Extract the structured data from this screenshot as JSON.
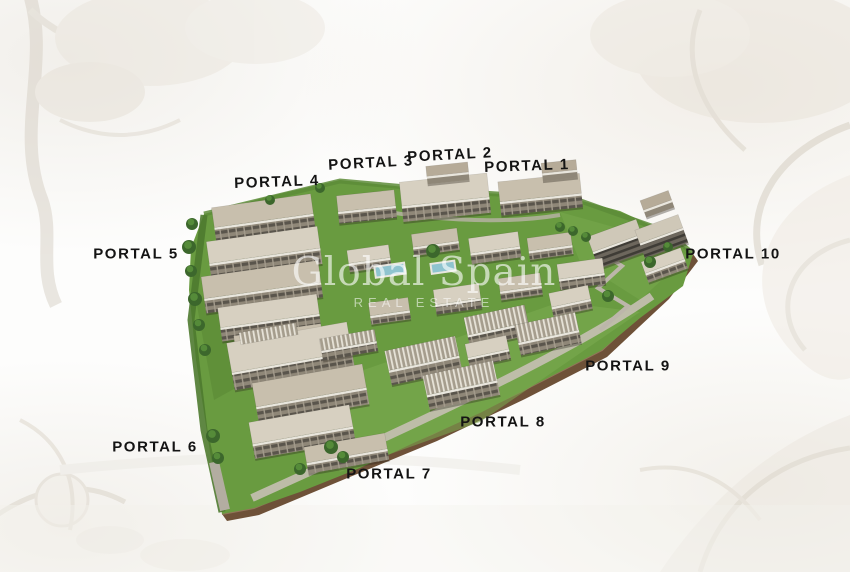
{
  "watermark": {
    "brand": "Global Spain",
    "tagline": "REAL ESTATE"
  },
  "site": {
    "portals": [
      {
        "id": "portal-1",
        "label": "PORTAL 1"
      },
      {
        "id": "portal-2",
        "label": "PORTAL 2"
      },
      {
        "id": "portal-3",
        "label": "PORTAL 3"
      },
      {
        "id": "portal-4",
        "label": "PORTAL 4"
      },
      {
        "id": "portal-5",
        "label": "PORTAL 5"
      },
      {
        "id": "portal-6",
        "label": "PORTAL 6"
      },
      {
        "id": "portal-7",
        "label": "PORTAL 7"
      },
      {
        "id": "portal-8",
        "label": "PORTAL 8"
      },
      {
        "id": "portal-9",
        "label": "PORTAL 9"
      },
      {
        "id": "portal-10",
        "label": "PORTAL 10"
      }
    ]
  },
  "colors": {
    "label_text": "#141414",
    "grass": "#699b40",
    "grass_light": "#7cab51",
    "building_roof": "#c8bfad",
    "building_roof_light": "#d7d0c1",
    "retaining_wall": "#6e5138",
    "pool": "#8fc4cf",
    "watermark_text": "#ffffff"
  }
}
